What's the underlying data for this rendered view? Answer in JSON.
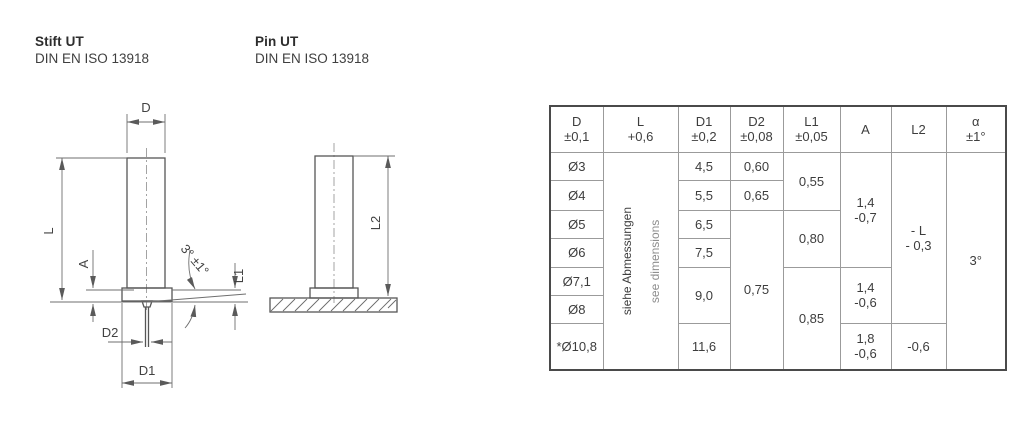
{
  "titles": [
    {
      "name": "Stift UT",
      "standard": "DIN EN ISO 13918"
    },
    {
      "name": "Pin UT",
      "standard": "DIN EN ISO 13918"
    }
  ],
  "drawing": {
    "labels": {
      "d": "D",
      "l": "L",
      "a": "A",
      "d2": "D2",
      "d1": "D1",
      "l1": "L1",
      "l2": "L2",
      "angle": "3° ±1°"
    }
  },
  "table": {
    "headers": [
      "D\n±0,1",
      "L\n+0,6",
      "D1\n±0,2",
      "D2\n±0,08",
      "L1\n±0,05",
      "A",
      "L2",
      "α\n±1°"
    ],
    "note_de": "siehe Abmessungen",
    "note_en": "see dimensions",
    "rows_d": [
      "Ø3",
      "Ø4",
      "Ø5",
      "Ø6",
      "Ø7,1",
      "Ø8",
      "*Ø10,8"
    ],
    "d1": [
      "4,5",
      "5,5",
      "6,5",
      "7,5",
      "9,0",
      "11,6"
    ],
    "d2": [
      "0,60",
      "0,65",
      "0,75"
    ],
    "l1": [
      "0,55",
      "0,80",
      "0,85"
    ],
    "a": [
      "1,4\n-0,7",
      "1,4\n-0,6",
      "1,8\n-0,6"
    ],
    "l2": [
      "- L\n- 0,3",
      "-0,6"
    ],
    "alpha": "3°"
  },
  "colors": {
    "outline": "#565656",
    "dimension_lines": "#6f6f6f",
    "table_outer_border": "#4a4a4a",
    "table_inner_border": "#9b9b9b",
    "text": "#3d3d3d",
    "note_secondary": "#8e8e8e"
  }
}
